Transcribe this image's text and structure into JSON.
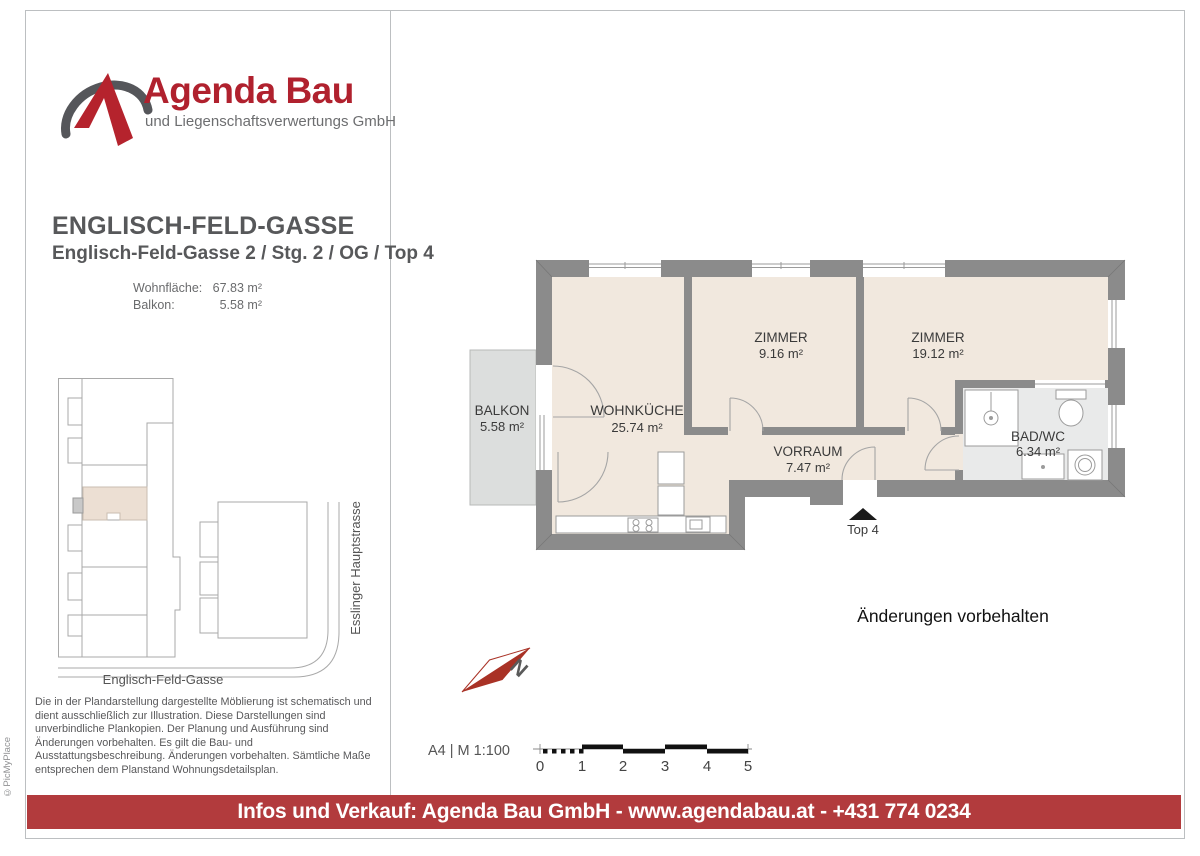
{
  "brand": {
    "name": "Agenda Bau",
    "subtitle": "und Liegenschaftsverwertungs GmbH",
    "logo_red": "#b5232d",
    "logo_gray": "#55565a"
  },
  "header": {
    "title": "ENGLISCH-FELD-GASSE",
    "subtitle": "Englisch-Feld-Gasse 2 / Stg. 2 / OG / Top 4"
  },
  "areas": {
    "rows": [
      {
        "label": "Wohnfläche:",
        "value": "67.83 m²"
      },
      {
        "label": "Balkon:",
        "value": "5.58 m²"
      }
    ]
  },
  "site_plan": {
    "street_bottom": "Englisch-Feld-Gasse",
    "street_right": "Esslinger Hauptstrasse",
    "highlight_color": "#ecdfd3"
  },
  "floor_plan": {
    "rooms": [
      {
        "name": "BALKON",
        "area": "5.58 m²"
      },
      {
        "name": "WOHNKÜCHE",
        "area": "25.74 m²"
      },
      {
        "name": "ZIMMER",
        "area": "9.16 m²"
      },
      {
        "name": "ZIMMER",
        "area": "19.12 m²"
      },
      {
        "name": "VORRAUM",
        "area": "7.47 m²"
      },
      {
        "name": "BAD/WC",
        "area": "6.34 m²"
      }
    ],
    "entrance_label": "Top 4",
    "wall_color": "#8b8b8b",
    "floor_color": "#f1e8de",
    "bath_floor_color": "#e9eaea",
    "balcony_color": "#dcdedd"
  },
  "notes": {
    "changes": "Änderungen vorbehalten",
    "disclaimer": "Die in der Plandarstellung dargestellte Möblierung ist schematisch und dient ausschließlich zur Illustration. Diese Darstellungen sind unverbindliche Plankopien. Der Planung und Ausführung sind Änderungen vorbehalten. Es gilt die Bau- und Ausstattungsbeschreibung. Änderungen vorbehalten. Sämtliche Maße entsprechen dem Planstand Wohnungsdetailsplan."
  },
  "scale": {
    "label": "A4 | M 1:100",
    "ticks": [
      "0",
      "1",
      "2",
      "3",
      "4",
      "5"
    ]
  },
  "compass": {
    "label": "N"
  },
  "footer": {
    "text": "Infos und Verkauf: Agenda Bau GmbH - www.agendabau.at - +431 774 0234",
    "bg": "#b23b3d"
  },
  "watermark": "©PicMyPlace"
}
